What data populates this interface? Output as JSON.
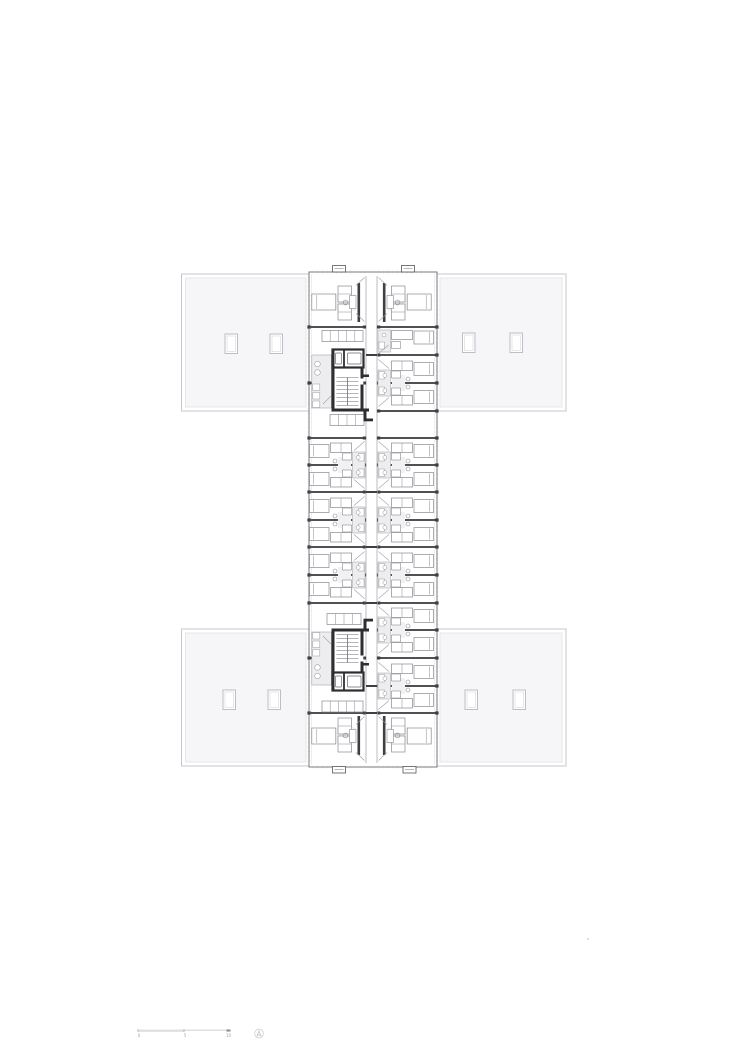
{
  "page": {
    "background": "#ffffff"
  },
  "drawing": {
    "type": "architectural-floor-plan",
    "description": "dormitory floor plan: central room spine with two stair cores, four flat-roof wings with skylights",
    "colors": {
      "paper": "#ffffff",
      "wing_fill": "#f6f6f8",
      "wing_border": "#c7c7cb",
      "wing_inner_border": "#e1e1e5",
      "skylight_border": "#b7b7bd",
      "skylight_inner": "#d8d8dc",
      "line_light": "#b6b6ba",
      "line_mid": "#8a8a90",
      "line_dark": "#3e3e43",
      "wall_heavy": "#2d2d32",
      "facade": "#6a6a70",
      "pod_fill": "#ededef",
      "rug_fill": "#f1f1f3"
    },
    "spine": {
      "x": 309,
      "y": 272,
      "w": 128,
      "h": 495
    },
    "corridor": {
      "x1": 366,
      "x2": 377,
      "y1": 276,
      "y2": 763
    },
    "wings": [
      {
        "name": "top-left",
        "x": 181.5,
        "y": 274,
        "w": 128.5,
        "h": 137,
        "skylights": [
          [
            225,
            334
          ],
          [
            270,
            334
          ]
        ]
      },
      {
        "name": "top-right",
        "x": 436,
        "y": 274,
        "w": 130,
        "h": 137,
        "skylights": [
          [
            462.5,
            333
          ],
          [
            510,
            333
          ]
        ]
      },
      {
        "name": "bottom-left",
        "x": 181.5,
        "y": 629,
        "w": 128.5,
        "h": 137,
        "skylights": [
          [
            223,
            690
          ],
          [
            268,
            690
          ]
        ]
      },
      {
        "name": "bottom-right",
        "x": 436,
        "y": 629,
        "w": 130,
        "h": 137,
        "skylights": [
          [
            465,
            690
          ],
          [
            513,
            690
          ]
        ]
      }
    ],
    "facade_tabs": [
      [
        332.5,
        265.5
      ],
      [
        401.5,
        265.5
      ],
      [
        332.5,
        766.5
      ],
      [
        403,
        766.5
      ]
    ],
    "walls_right": [
      327,
      355,
      383,
      411,
      438,
      465,
      492,
      520,
      547,
      575,
      603,
      630,
      658,
      686,
      713
    ],
    "walls_left": [
      327,
      438,
      465,
      492,
      520,
      547,
      575,
      603,
      713
    ],
    "wall_stubs_left": [
      {
        "y": 383,
        "len": 22
      },
      {
        "y": 658,
        "len": 13
      }
    ],
    "corridor_crossings": [
      355,
      492,
      547,
      603,
      686,
      713
    ],
    "corridor_jambs": [
      327,
      383,
      411,
      438,
      465,
      520,
      575,
      630,
      658
    ],
    "clusters_right": [
      383,
      465,
      520,
      575,
      630,
      686
    ],
    "clusters_left": [
      465,
      520,
      575
    ],
    "end_module_right_y": 329,
    "shelf_rows": [
      [
        322,
        330.5,
        41,
        5
      ],
      [
        330,
        414.5,
        34,
        4
      ],
      [
        327,
        613.5,
        34,
        4
      ],
      [
        322,
        701,
        41,
        5
      ]
    ],
    "cores": [
      {
        "flipped": false
      },
      {
        "flipped": true
      }
    ],
    "tick_step": 4.7,
    "speck": {
      "x": 588,
      "y": 939
    }
  },
  "scale_bar": {
    "labels": [
      "0",
      "5",
      "10"
    ],
    "ticks_x": [
      138,
      184,
      228
    ],
    "y": 1030.5
  },
  "north_indicator": {
    "x": 259,
    "y": 1033.5,
    "r": 4.3
  }
}
